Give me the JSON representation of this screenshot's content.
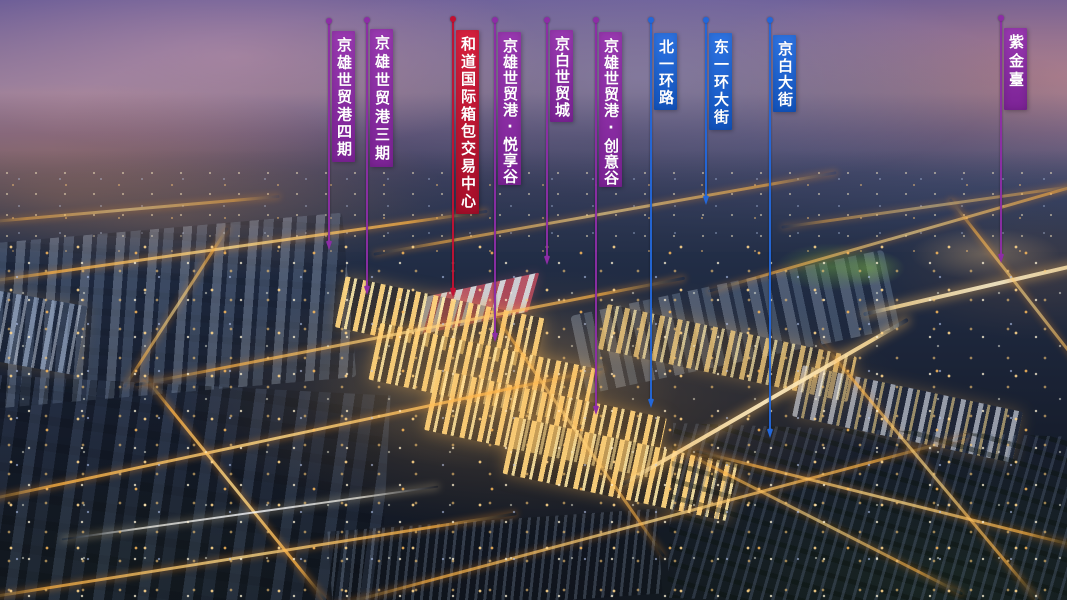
{
  "flag_themes": {
    "purple": {
      "top": "#9a39b2",
      "bottom": "#7c2396",
      "pole": "#8d2da6"
    },
    "red": {
      "top": "#d8203e",
      "bottom": "#a50e29",
      "pole": "#c21132"
    },
    "blue": {
      "top": "#2e74e4",
      "bottom": "#1254be",
      "pole": "#2367d9"
    }
  },
  "flag_text_color": "#ffffff",
  "banners": [
    {
      "label": "京雄世贸港四期",
      "theme": "purple",
      "pole_x": 328,
      "dot_y": 21,
      "flag_top": 31,
      "flag_height": 131,
      "pole_end_y": 245
    },
    {
      "label": "京雄世贸港三期",
      "theme": "purple",
      "pole_x": 366,
      "dot_y": 20,
      "flag_top": 29,
      "flag_height": 138,
      "pole_end_y": 290
    },
    {
      "label": "和道国际箱包交易中心",
      "theme": "red",
      "pole_x": 452,
      "dot_y": 19,
      "flag_top": 30,
      "flag_height": 184,
      "pole_end_y": 292
    },
    {
      "label": "京雄世贸港·悦享谷",
      "theme": "purple",
      "pole_x": 494,
      "dot_y": 20,
      "flag_top": 32,
      "flag_height": 153,
      "pole_end_y": 337
    },
    {
      "label": "京白世贸城",
      "theme": "purple",
      "pole_x": 546,
      "dot_y": 20,
      "flag_top": 30,
      "flag_height": 92,
      "pole_end_y": 260
    },
    {
      "label": "京雄世贸港·创意谷",
      "theme": "purple",
      "pole_x": 595,
      "dot_y": 20,
      "flag_top": 32,
      "flag_height": 155,
      "pole_end_y": 410
    },
    {
      "label": "北一环路",
      "theme": "blue",
      "pole_x": 650,
      "dot_y": 20,
      "flag_top": 33,
      "flag_height": 77,
      "pole_end_y": 403
    },
    {
      "label": "东一环大街",
      "theme": "blue",
      "pole_x": 705,
      "dot_y": 20,
      "flag_top": 33,
      "flag_height": 97,
      "pole_end_y": 200
    },
    {
      "label": "京白大街",
      "theme": "blue",
      "pole_x": 769,
      "dot_y": 20,
      "flag_top": 35,
      "flag_height": 77,
      "pole_end_y": 433
    },
    {
      "label": "紫金臺",
      "theme": "purple",
      "pole_x": 1000,
      "dot_y": 18,
      "flag_top": 28,
      "flag_height": 82,
      "bottom_pad": 16,
      "pole_end_y": 258
    }
  ]
}
